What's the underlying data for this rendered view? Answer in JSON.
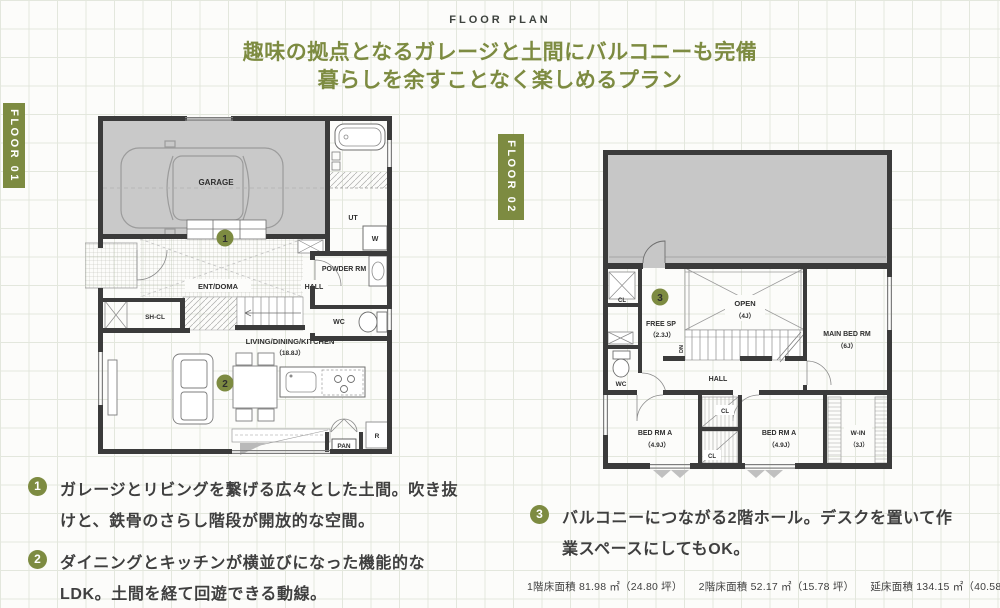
{
  "page": {
    "eyebrow": "FLOOR PLAN",
    "title_line1": "趣味の拠点となるガレージと土間にバルコニーも完備",
    "title_line2": "暮らしを余すことなく楽しめるプラン"
  },
  "floor1": {
    "banner": "FLOOR 01",
    "labels": {
      "garage": "GARAGE",
      "ent_doma": "ENT/DOMA",
      "sh_cl": "SH-CL",
      "hall": "HALL",
      "powder": "POWDER RM",
      "wc": "WC",
      "ut": "UT",
      "washer": "W",
      "ldk": "LIVING/DINING/KITCHEN",
      "ldk_size": "（18.8J）",
      "pan": "PAN",
      "fridge": "R"
    },
    "markers": {
      "one": "1",
      "two": "2"
    }
  },
  "floor2": {
    "banner": "FLOOR 02",
    "labels": {
      "cl_top": "CL",
      "wc": "WC",
      "free_sp": "FREE SP",
      "free_sp_size": "（2.3J）",
      "open": "OPEN",
      "open_size": "（4J）",
      "dn": "DN",
      "main_bed": "MAIN BED RM",
      "main_bed_size": "（6J）",
      "hall": "HALL",
      "bed_a1": "BED RM A",
      "bed_a1_size": "（4.9J）",
      "bed_a2": "BED RM A",
      "bed_a2_size": "（4.9J）",
      "cl_mid1": "CL",
      "cl_mid2": "CL",
      "walk_in": "W-IN",
      "walk_in_size": "（3J）"
    },
    "markers": {
      "three": "3"
    }
  },
  "notes": [
    {
      "num": "1",
      "line1": "ガレージとリビングを繋げる広々とした土間。吹き抜",
      "line2": "けと、鉄骨のさらし階段が開放的な空間。"
    },
    {
      "num": "2",
      "line1": "ダイニングとキッチンが横並びになった機能的な",
      "line2": "LDK。土間を経て回遊できる動線。"
    },
    {
      "num": "3",
      "line1": "バルコニーにつながる2階ホール。デスクを置いて作",
      "line2": "業スペースにしてもOK。"
    }
  ],
  "areas": {
    "floor1": "1階床面積 81.98 ㎡（24.80 坪）",
    "floor2": "2階床面積 52.17 ㎡（15.78 坪）",
    "total": "延床面積 134.15 ㎡（40.58 坪）"
  },
  "colors": {
    "accent": "#7d8b41",
    "wall": "#3b3b3b",
    "gray_fill": "#c9c9c9"
  }
}
